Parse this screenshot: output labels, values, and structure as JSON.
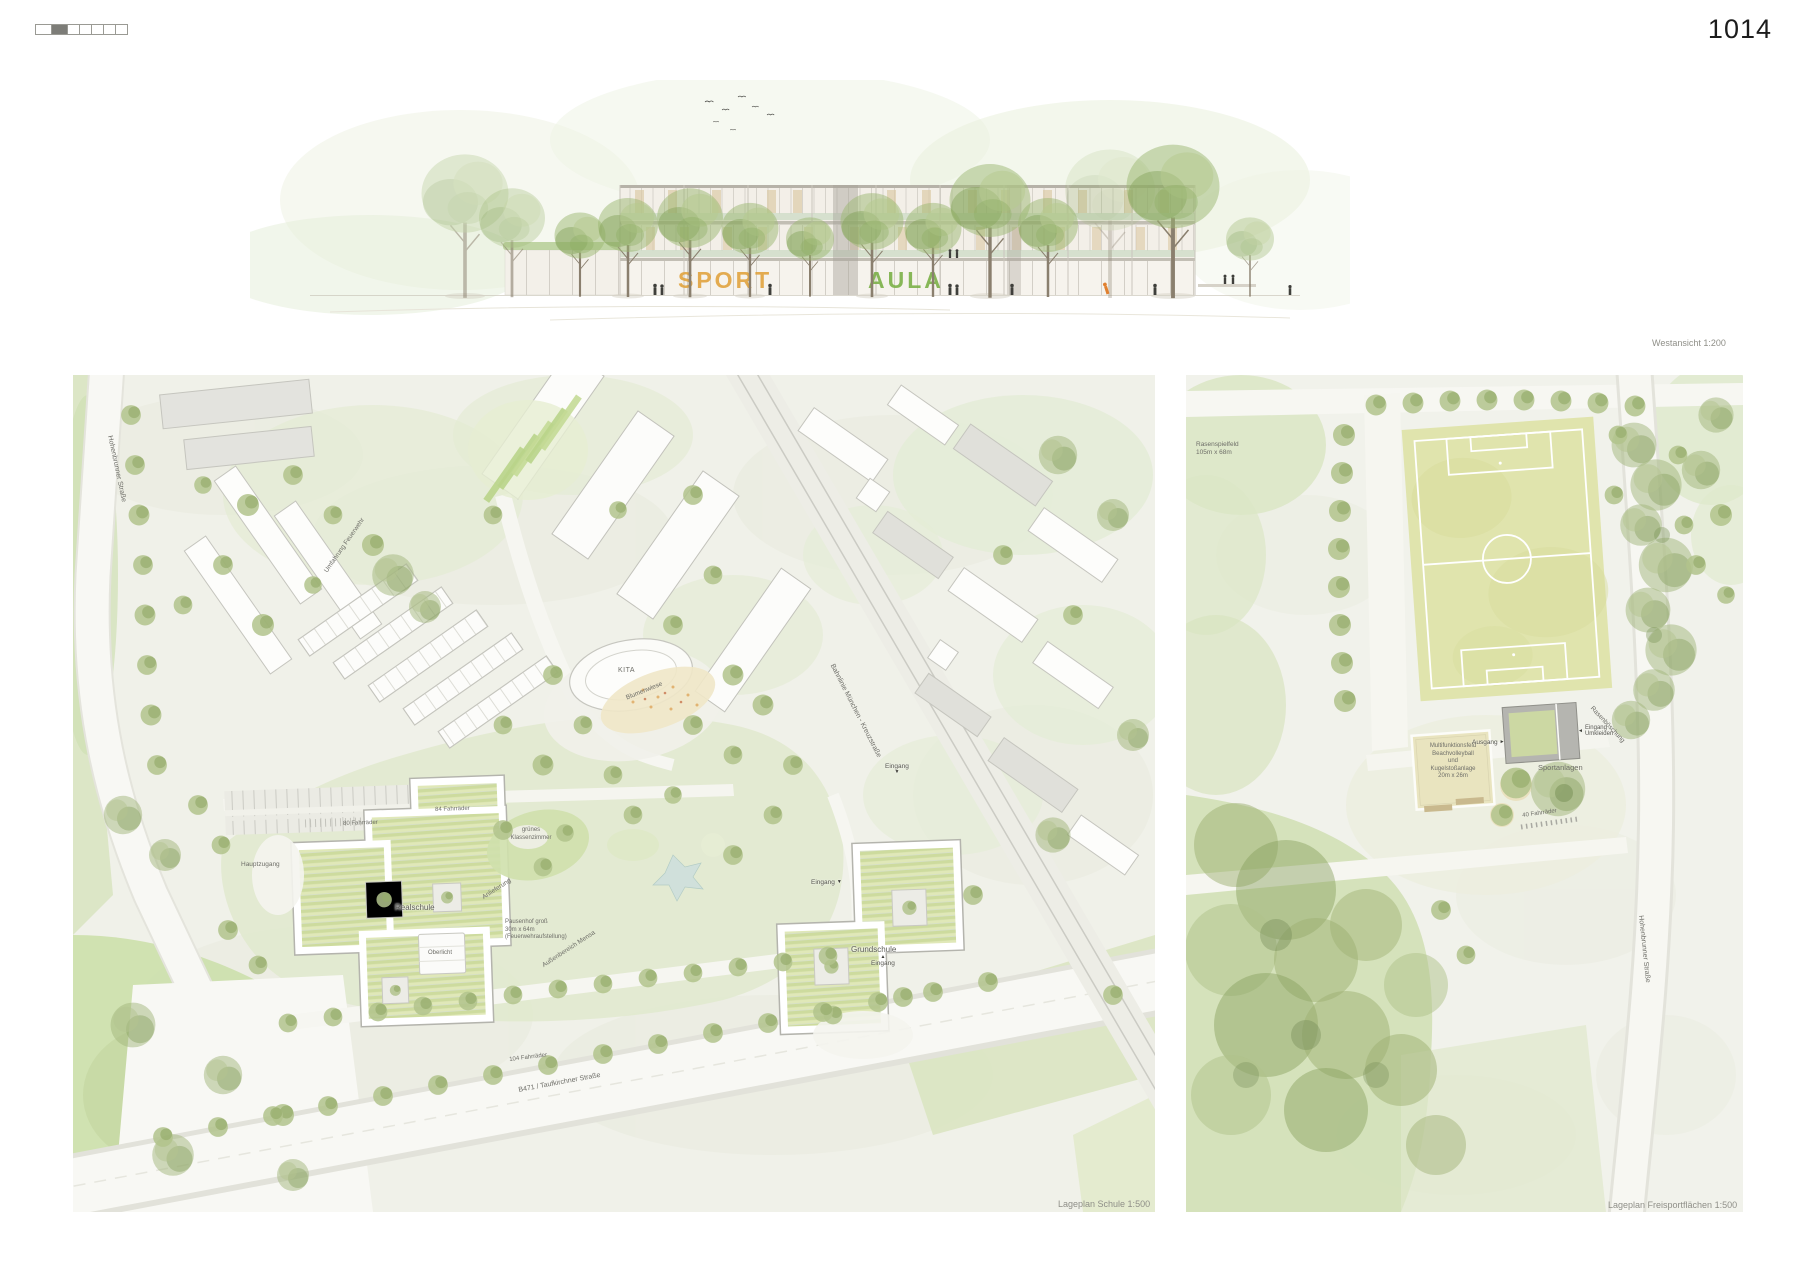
{
  "page": {
    "number": "1014"
  },
  "icons": {
    "arrow_down": "▼",
    "arrow_up": "▲",
    "arrow_right": "►",
    "arrow_left": "◄"
  },
  "elevation": {
    "caption": "Westansicht 1:200",
    "facade_text_sport": "SPORT",
    "facade_text_aula": "AULA",
    "colors": {
      "sport": "#e09f35",
      "aula": "#7cb148"
    }
  },
  "plan_school": {
    "caption": "Lageplan Schule 1:500",
    "labels": {
      "hohenbrunner": "Hohenbrunner Straße",
      "umfahrung": "Umfahrung Feuerwehr",
      "bikes80": "80 Fahrräder",
      "bikes84": "84 Fahrräder",
      "bikes104": "104 Fahrräder",
      "blumenwiese": "Blumenwiese",
      "kita": "KITA",
      "gruenes_klassenzimmer": "grünes\nKlassenzimmer",
      "anlieferung": "Anlieferung",
      "mensa": "Außenbereich Mensa",
      "pausenhof": "Pausenhof groß\n30m x 64m\n(Feuerwehraufstellung)",
      "realschule": "Realschule",
      "oberlicht": "Oberlicht",
      "grundschule": "Grundschule",
      "eingang": "Eingang",
      "hauptzugang": "Hauptzugang",
      "b471": "B471 / Taufkirchner Straße",
      "bahnlinie": "Bahnlinie München - Kreuzstraße"
    }
  },
  "plan_sports": {
    "caption": "Lageplan Freisportflächen 1:500",
    "labels": {
      "rasenspielfeld": "Rasenspielfeld\n105m x 68m",
      "multifunktionsfeld": "Multifunktionsfeld\nBeachvolleyball\nund\nKugelstoßanlage\n20m x 26m",
      "ausgang": "Ausgang",
      "eingang_umkleiden": "Eingang\nUmkleiden",
      "sportanlagen": "Sportanlagen",
      "bikes40": "40 Fahrräder",
      "rasenboeschung": "Rasenböschung",
      "hohenbrunner": "Hohenbrunner Straße"
    }
  }
}
